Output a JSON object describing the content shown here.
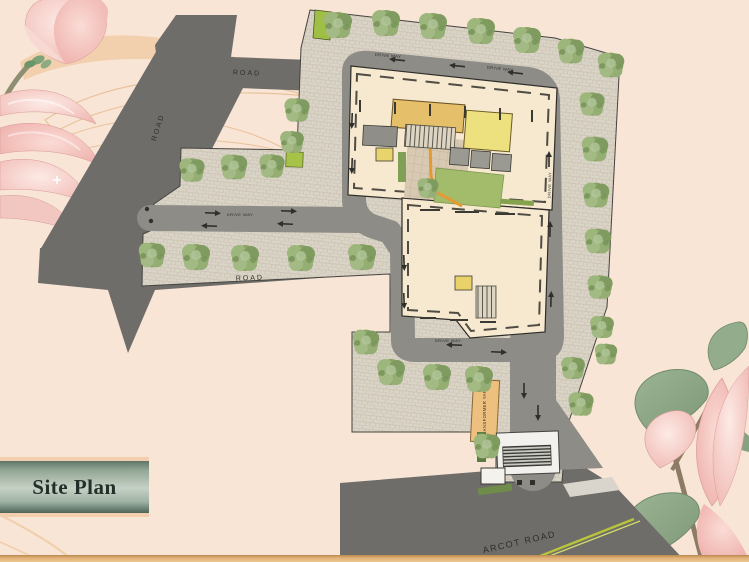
{
  "header": {
    "label": "Site Plan"
  },
  "plan_labels": {
    "road": "ROAD",
    "arcot_road": "ARCOT ROAD",
    "drive_way": "DRIVE WAY",
    "transformer_yard": "TRANSFORMER YARD"
  },
  "palette": {
    "background_peach": "#f8e5d5",
    "external_road_gray": "#6e6d69",
    "internal_driveway_gray": "#8d8c86",
    "perimeter_paving": "#dad4c7",
    "building_cream": "#f7e9cf",
    "clubhouse_gold": "#e5bf69",
    "deck_yellow": "#ede17f",
    "lawn_green": "#a3bc6b",
    "tree_green": "#8aa465",
    "transformer_orange": "#eec07f",
    "road_median_yellow": "#b8c43c",
    "label_box_green": "#93a795",
    "border_peach": "#f2cfae",
    "bottom_bar_gold": "#e2b279"
  }
}
